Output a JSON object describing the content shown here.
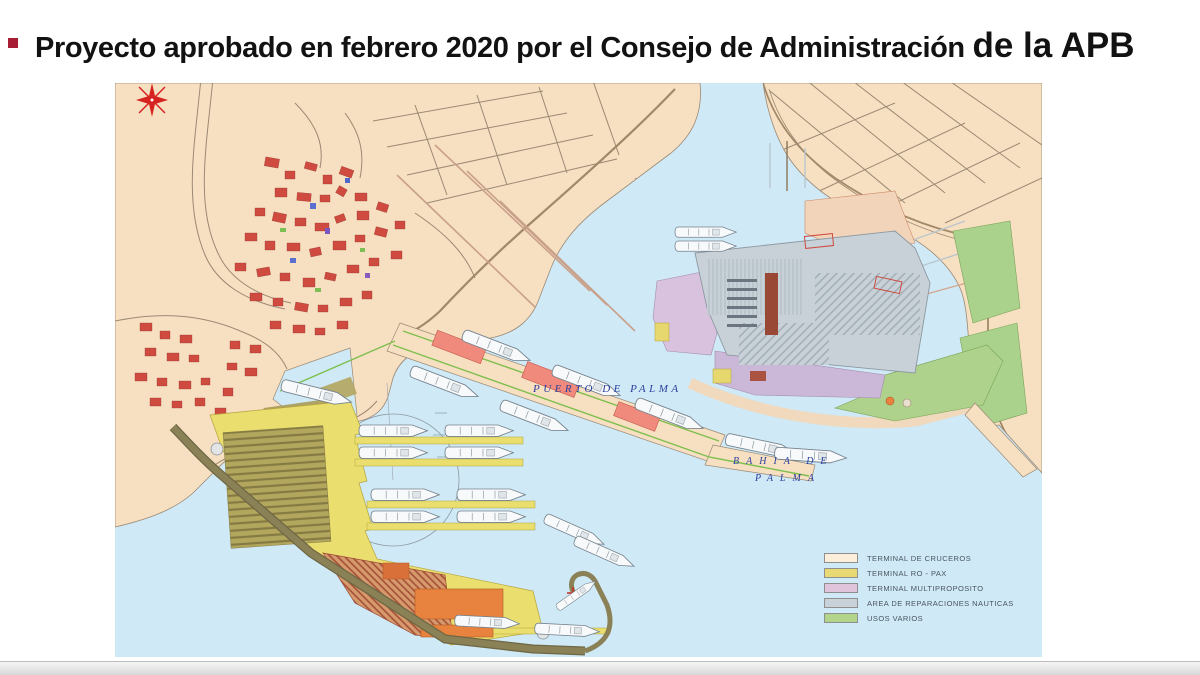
{
  "slide": {
    "title": {
      "text_main": "Proyecto aprobado en febrero 2020 por el Consejo de Administración",
      "text_emphasis": "de la APB",
      "bullet_color": "#a81e35"
    }
  },
  "map": {
    "water_labels": {
      "harbor": "PUERTO DE PALMA",
      "bay_line1": "BAHIA DE",
      "bay_line2": "PALMA"
    },
    "palette": {
      "land": "#f7dfc1",
      "water": "#cfe9f6",
      "city_blocks": "#cf4b40",
      "roads": "#9b8974",
      "breakwater": "#8b8157",
      "ropax_yellow": "#e9de6e",
      "cruise_building": "#ef8a7c",
      "compass_red": "#d6231f",
      "label_blue": "#2a3f9e"
    },
    "legend": {
      "items": [
        {
          "label": "TERMINAL DE CRUCEROS",
          "color": "#fdeeda"
        },
        {
          "label": "TERMINAL RO - PAX",
          "color": "#e9d973"
        },
        {
          "label": "TERMINAL MULTIPROPOSITO",
          "color": "#e0c4dc"
        },
        {
          "label": "AREA DE REPARACIONES NAUTICAS",
          "color": "#c8d2d8"
        },
        {
          "label": "USOS VARIOS",
          "color": "#b2d48b"
        }
      ]
    }
  }
}
